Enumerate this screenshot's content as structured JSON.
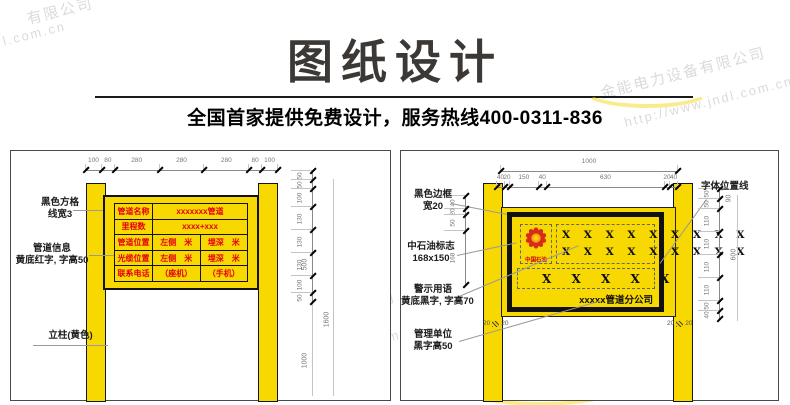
{
  "header": {
    "title": "图纸设计",
    "subtitle": "全国首家提供免费设计，服务热线400-0311-836"
  },
  "watermarks": {
    "tl1": "有限公司",
    "tl2": "l.com.cn",
    "tr1": "金能电力设备有限公司",
    "tr2": "http://www.jndl.com.cn",
    "lp1": "金能电力设备有限公司",
    "lp2": "http://www.jndl.com.cn",
    "rp1": "金能电力设备有限公司",
    "rp2": "http://www.jndl.com.cn"
  },
  "left_diagram": {
    "top_dims": [
      "100",
      "80",
      "280",
      "280",
      "280",
      "80",
      "100"
    ],
    "side_dims": [
      "50",
      "50",
      "100",
      "130",
      "130",
      "130",
      "100",
      "50"
    ],
    "side_totals": {
      "upper": "500",
      "lower": "1000",
      "overall": "1600"
    },
    "labels": {
      "grid_line1": "黑色方格",
      "grid_line2": "线宽3",
      "info_line1": "管道信息",
      "info_line2": "黄底红字, 字高50",
      "post": "立柱(黄色)"
    },
    "table": {
      "rows": [
        {
          "label": "管道名称",
          "value": "xxxxxxx管道"
        },
        {
          "label": "里程数",
          "value": "xxxx+xxx"
        },
        {
          "label": "管道位置",
          "cell1": "左侧　米",
          "cell2": "埋深　米"
        },
        {
          "label": "光缆位置",
          "cell1": "左侧　米",
          "cell2": "埋深　米"
        },
        {
          "label": "联系电话",
          "cell1": "（座机）",
          "cell2": "（手机）"
        }
      ]
    }
  },
  "right_diagram": {
    "top_total": "1000",
    "top_dims": [
      "40",
      "20",
      "150",
      "40",
      "630",
      "20",
      "40"
    ],
    "left_dims": [
      "40",
      "20",
      "50",
      "168"
    ],
    "side_dims": [
      "50",
      "50",
      "110",
      "110",
      "110",
      "110",
      "50",
      "40"
    ],
    "side_offset": "90",
    "side_total": "600",
    "post_gap_dims": [
      "20",
      "20",
      "20",
      "20"
    ],
    "labels": {
      "border_line1": "黑色边框",
      "border_line2": "宽20",
      "logo_line1": "中石油标志",
      "logo_line2": "168x150",
      "warn_line1": "警示用语",
      "warn_line2": "黄底黑字, 字高70",
      "mgmt_line1": "管理单位",
      "mgmt_line2": "黑字高50",
      "font_pos": "字体位置线"
    },
    "board": {
      "logo_caption": "中国石油",
      "x_row1": "X X X X X X X X X",
      "x_row2": "X X X X X X X X X",
      "x_row3": "X X X X X",
      "company": "xxxxx管道分公司"
    }
  },
  "colors": {
    "sign_yellow": "#f7d800",
    "sign_red_text": "#e60012",
    "frame_black": "#111111",
    "dimension_gray": "#8a8a8a",
    "title_gray": "#3c3835"
  }
}
